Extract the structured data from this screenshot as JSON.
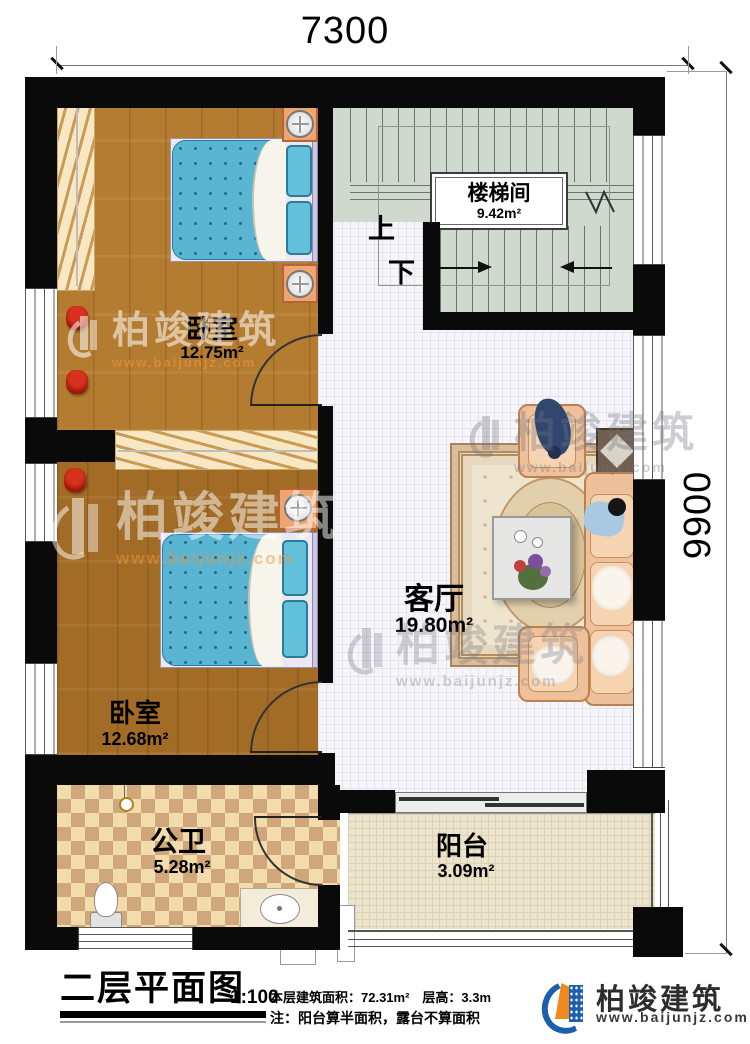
{
  "plan": {
    "dim_top": "7300",
    "dim_right": "9900",
    "rooms": {
      "bedroom1": {
        "name": "卧室",
        "area": "12.75m²"
      },
      "bedroom2": {
        "name": "卧室",
        "area": "12.68m²"
      },
      "stairwell": {
        "name": "楼梯间",
        "area": "9.42m²"
      },
      "living": {
        "name": "客厅",
        "area": "19.80m²"
      },
      "bathroom": {
        "name": "公卫",
        "area": "5.28m²"
      },
      "balcony": {
        "name": "阳台",
        "area": "3.09m²"
      }
    },
    "stairs": {
      "up": "上",
      "down": "下"
    }
  },
  "title_block": {
    "title": "二层平面图",
    "scale": "1:100",
    "info_line1": "本层建筑面积：72.31m²　层高：3.3m",
    "info_line2": "注：阳台算半面积，露台不算面积"
  },
  "brand": {
    "name": "柏竣建筑",
    "url": "www.baijunjz.com"
  },
  "watermark": {
    "name": "柏竣建筑",
    "url": "www.baijunjz.com"
  },
  "colors": {
    "wall": "#0a0a0a",
    "brand_blue": "#1b5fae",
    "brand_orange": "#f0891e",
    "mattress": "#5ab5d2",
    "sofa": "#eec09c"
  }
}
